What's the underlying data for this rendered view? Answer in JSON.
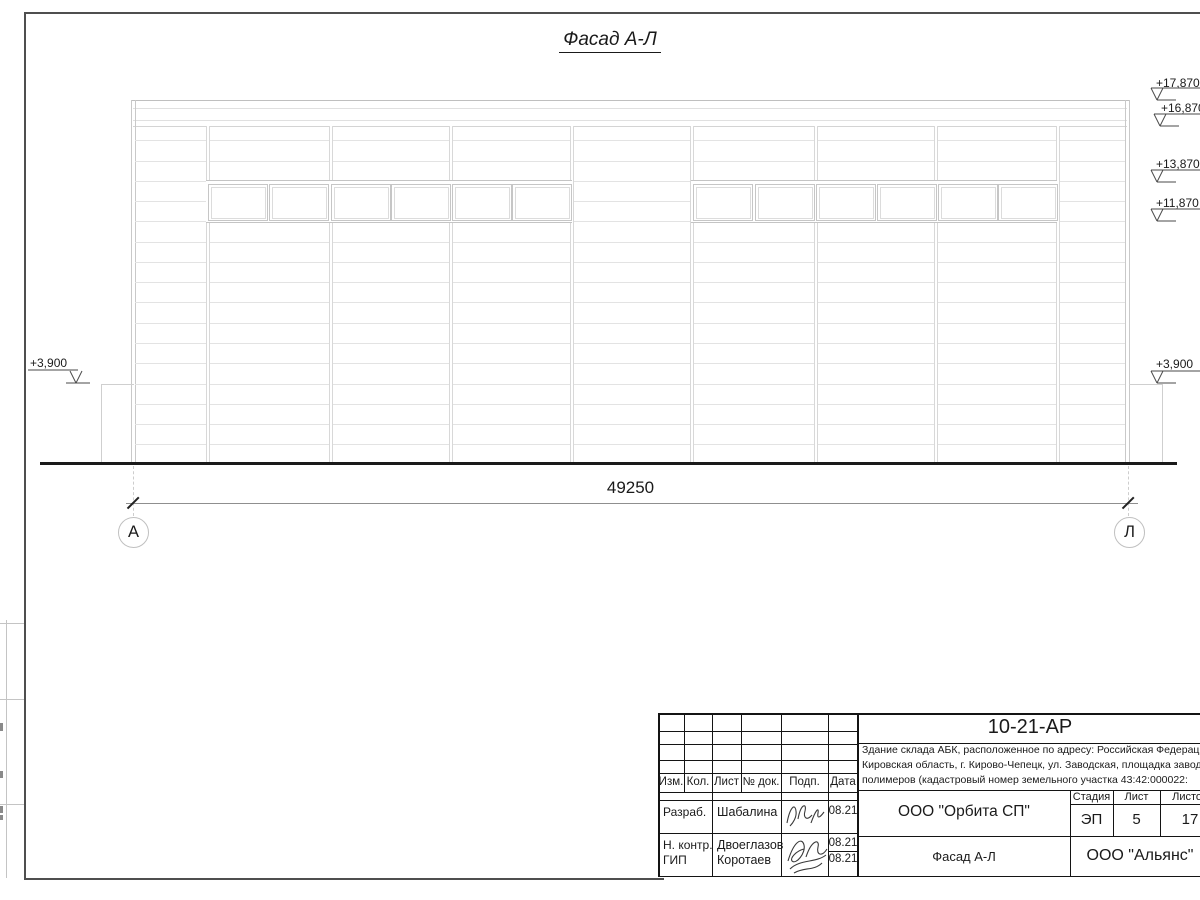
{
  "drawing": {
    "title": "Фасад А-Л",
    "dimension_total": "49250",
    "axis_left": "А",
    "axis_right": "Л",
    "elevations_right": [
      "+17,870",
      "+16,870",
      "+13,870",
      "+11,870",
      "+3,900"
    ],
    "elevation_left": "+3,900"
  },
  "titleblock": {
    "project_code": "10-21-АР",
    "description_line1": "Здание склада АБК, расположенное по адресу: Российская Федерация,",
    "description_line2": "Кировская область, г. Кирово-Чепецк, ул. Заводская, площадка завода",
    "description_line3": "полимеров (кадастровый номер земельного участка 43:42:000022:",
    "header_columns": [
      "Изм.",
      "Кол.",
      "Лист",
      "№ док.",
      "Подп.",
      "Дата"
    ],
    "staff": [
      {
        "role": "Разраб.",
        "name": "Шабалина",
        "date": "08.21"
      },
      {
        "role": "Н. контр.",
        "name": "Двоеглазов",
        "date": "08.21"
      },
      {
        "role": "ГИП",
        "name": "Коротаев",
        "date": "08.21"
      }
    ],
    "designer_org": "ООО \"Орбита СП\"",
    "stage_label": "Стадия",
    "sheet_label": "Лист",
    "sheets_label": "Листов",
    "stage": "ЭП",
    "sheet_no": "5",
    "sheets_total": "17",
    "sheet_title": "Фасад А-Л",
    "client_org": "ООО \"Альянс\""
  },
  "colors": {
    "ground_line": "#1a1a1a",
    "facade_lines": "#e3e3e3",
    "frame": "#4f4f4f",
    "titleblock_lines": "#111111"
  }
}
